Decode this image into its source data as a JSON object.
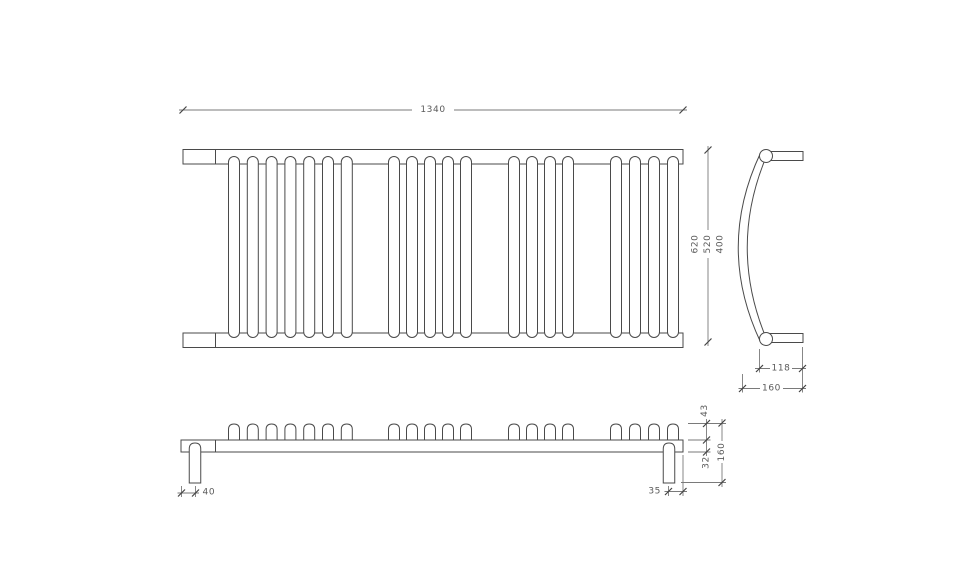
{
  "drawing": {
    "background": "#ffffff",
    "line_color": "#4a4a4a",
    "dim_line_color": "#7a7a7a",
    "text_color": "#5a5a5a",
    "plan": {
      "width_dim": "1340",
      "height_dims": [
        "620",
        "520",
        "400"
      ],
      "tube_groups": [
        {
          "start": 234,
          "count": 7,
          "spacing": 18.8
        },
        {
          "start": 394,
          "count": 5,
          "spacing": 18
        },
        {
          "start": 514,
          "count": 4,
          "spacing": 18
        },
        {
          "start": 616,
          "count": 4,
          "spacing": 19
        }
      ]
    },
    "side": {
      "upper_dim": "118",
      "lower_dim": "160"
    },
    "front": {
      "left_leg_dim": "40",
      "right_leg_dim": "35",
      "tube_height_dim": "43",
      "rail_thickness_dim": "32",
      "depth_dim": "160"
    }
  }
}
